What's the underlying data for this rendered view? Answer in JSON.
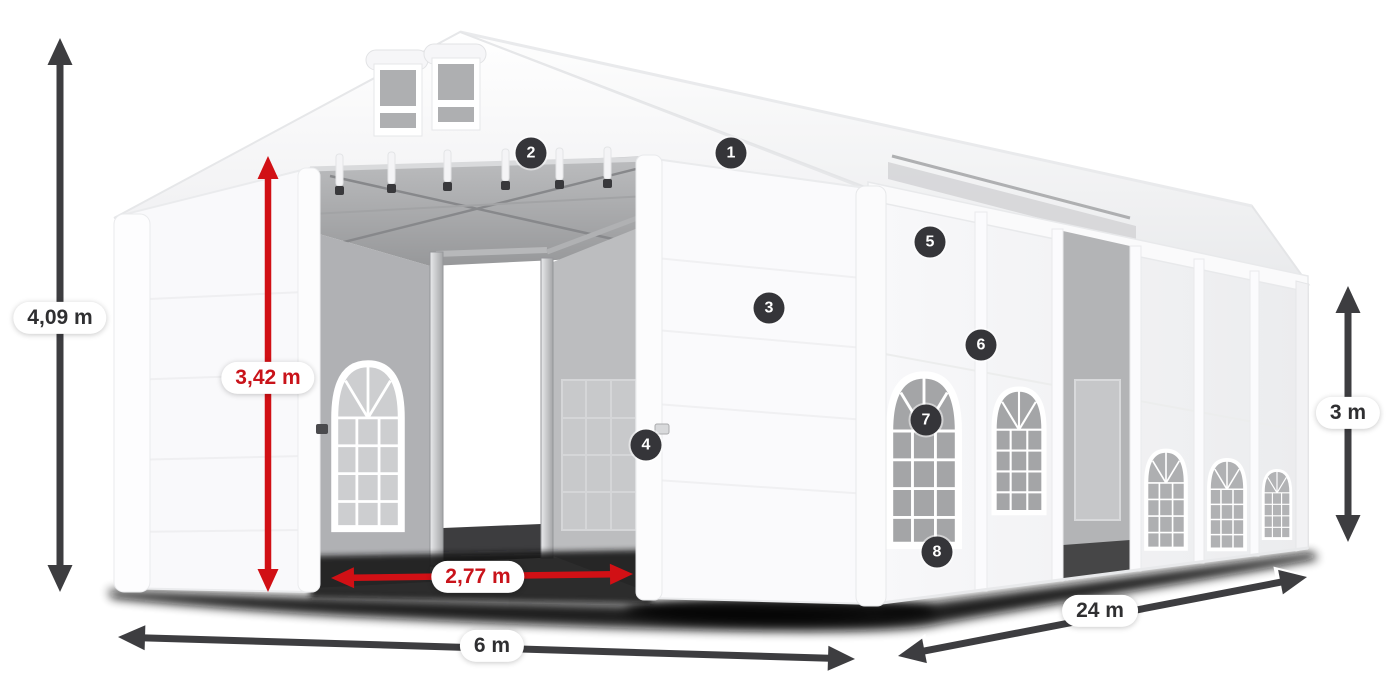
{
  "page": {
    "background": "#ffffff"
  },
  "diagram": {
    "subject": "marquee-tent-dimension-diagram",
    "colors": {
      "accent_red": "#d11015",
      "arrow_dark": "#3d3d40",
      "badge_bg": "#353539",
      "pill_bg": "#ffffff",
      "pill_text_dark": "#2f2f31",
      "pill_text_red": "#c9131a"
    },
    "measurements": {
      "total_height": "4,09 m",
      "entrance_height": "3,42 m",
      "entrance_width": "2,77 m",
      "width": "6 m",
      "length": "24 m",
      "side_wall_height": "3 m"
    },
    "markers": [
      {
        "number": "1"
      },
      {
        "number": "2"
      },
      {
        "number": "3"
      },
      {
        "number": "4"
      },
      {
        "number": "5"
      },
      {
        "number": "6"
      },
      {
        "number": "7"
      },
      {
        "number": "8"
      }
    ]
  }
}
